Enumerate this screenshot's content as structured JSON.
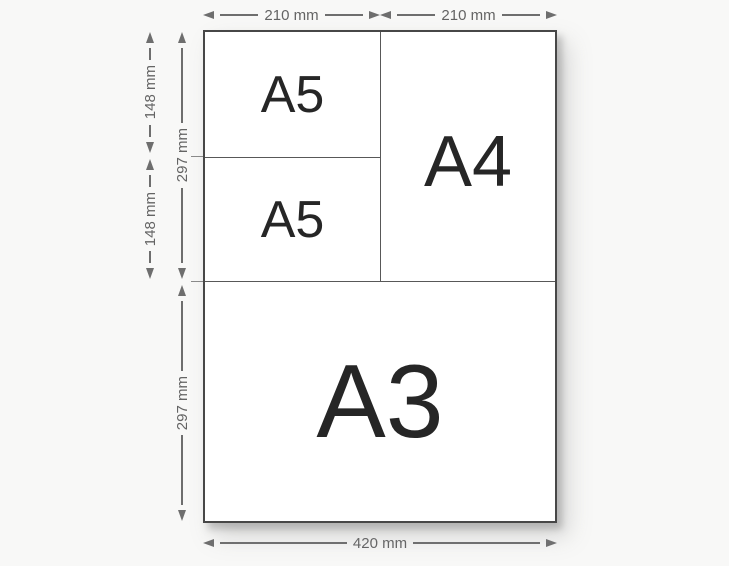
{
  "diagram": {
    "papers": {
      "a5_top": {
        "label": "A5"
      },
      "a5_bottom": {
        "label": "A5"
      },
      "a4": {
        "label": "A4"
      },
      "a3": {
        "label": "A3"
      }
    },
    "dimensions": {
      "top": [
        {
          "label": "210 mm"
        },
        {
          "label": "210 mm"
        }
      ],
      "left_outer": [
        {
          "label": "148 mm"
        },
        {
          "label": "148 mm"
        }
      ],
      "left_inner": [
        {
          "label": "297 mm"
        },
        {
          "label": "297 mm"
        }
      ],
      "bottom": {
        "label": "420 mm"
      }
    },
    "colors": {
      "background": "#f8f8f7",
      "paper": "#ffffff",
      "sheet_border": "#474747",
      "divider": "#585858",
      "dimension": "#6e6e6e",
      "dimension_text": "#646464",
      "label_text": "#262626"
    }
  }
}
